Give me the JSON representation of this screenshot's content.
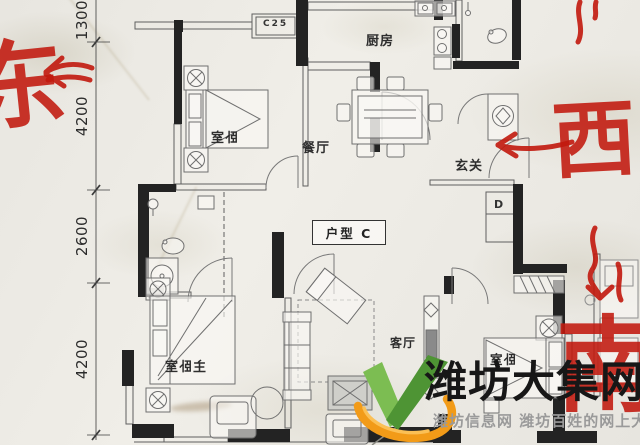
{
  "floor_plan": {
    "unit_label": "户型 C",
    "rooms": {
      "bedroom_top_left": "卧室",
      "kitchen": "厨房",
      "dining": "餐厅",
      "foyer": "玄关",
      "living": "客厅",
      "master_bedroom": "主卧室",
      "bedroom_bottom_right": "卧室",
      "closet_label": "D",
      "ac_unit_label": "C25"
    },
    "dimensions": [
      "1300",
      "4200",
      "2600",
      "4200"
    ],
    "wall_color": "#232323"
  },
  "annotations": {
    "ink_color": "#c2190e",
    "east": "东",
    "west": "西",
    "south": "南"
  },
  "watermark": {
    "title": "潍坊大集网",
    "subtitle": "潍坊信息网 潍坊百姓的网上大集",
    "title_color": "#171717",
    "subtitle_color": "#9a9a9a",
    "logo_green_light": "#7cbd52",
    "logo_green_dark": "#4e9434",
    "logo_orange": "#f29b18",
    "logo_orange_light": "#fbc055"
  }
}
